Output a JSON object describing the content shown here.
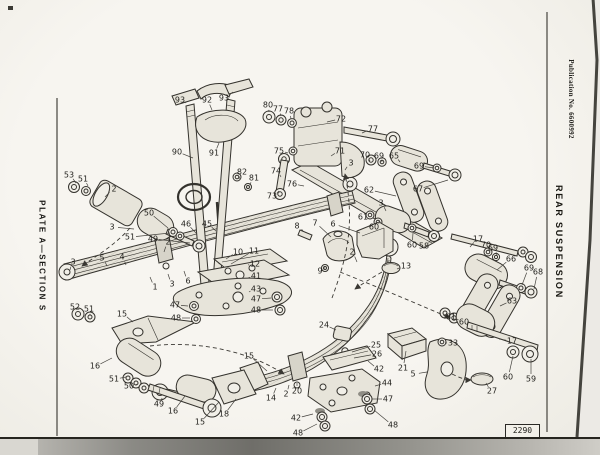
{
  "page": {
    "left_margin": {
      "plate_label": "PLATE A—SECTION S"
    },
    "right_margin": {
      "publication": "Publication No. 6600992",
      "title": "REAR SUSPENSION"
    },
    "figure_number": "2290"
  },
  "diagram": {
    "description": "Exploded parts diagram of a rear leaf-spring suspension: two leaf springs, shock absorber, U-bolts, shackles, bushes, mounting plates and fasteners, with numbered part callouts",
    "callouts": [
      {
        "n": "53",
        "x": 69,
        "y": 175,
        "lx": 76,
        "ly": 183
      },
      {
        "n": "51",
        "x": 83,
        "y": 179,
        "lx": 88,
        "ly": 186
      },
      {
        "n": "2",
        "x": 114,
        "y": 189,
        "lx": 105,
        "ly": 197
      },
      {
        "n": "50",
        "x": 149,
        "y": 213,
        "lx": 168,
        "ly": 228
      },
      {
        "n": "3",
        "x": 112,
        "y": 227,
        "lx": 134,
        "ly": 229
      },
      {
        "n": "51",
        "x": 130,
        "y": 237,
        "lx": 170,
        "ly": 233
      },
      {
        "n": "49",
        "x": 153,
        "y": 239,
        "lx": 190,
        "ly": 243
      },
      {
        "n": "3",
        "x": 73,
        "y": 262,
        "lx": 70,
        "ly": 270
      },
      {
        "n": "5",
        "x": 102,
        "y": 258,
        "lx": 107,
        "ly": 266
      },
      {
        "n": "4",
        "x": 122,
        "y": 257,
        "lx": 126,
        "ly": 265
      },
      {
        "n": "2",
        "x": 168,
        "y": 242,
        "lx": 164,
        "ly": 252
      },
      {
        "n": "1",
        "x": 155,
        "y": 287,
        "lx": 150,
        "ly": 277
      },
      {
        "n": "3",
        "x": 172,
        "y": 284,
        "lx": 168,
        "ly": 274
      },
      {
        "n": "6",
        "x": 188,
        "y": 281,
        "lx": 184,
        "ly": 271
      },
      {
        "n": "46",
        "x": 186,
        "y": 224,
        "lx": 196,
        "ly": 233
      },
      {
        "n": "45",
        "x": 207,
        "y": 224,
        "lx": 216,
        "ly": 231
      },
      {
        "n": "93",
        "x": 180,
        "y": 100,
        "lx": 186,
        "ly": 103
      },
      {
        "n": "92",
        "x": 207,
        "y": 100,
        "lx": 212,
        "ly": 110
      },
      {
        "n": "93",
        "x": 224,
        "y": 98,
        "lx": 233,
        "ly": 92
      },
      {
        "n": "90",
        "x": 177,
        "y": 152,
        "lx": 193,
        "ly": 158
      },
      {
        "n": "91",
        "x": 214,
        "y": 153,
        "lx": 219,
        "ly": 143
      },
      {
        "n": "82",
        "x": 242,
        "y": 172,
        "lx": 239,
        "ly": 179
      },
      {
        "n": "81",
        "x": 254,
        "y": 178,
        "lx": 250,
        "ly": 185
      },
      {
        "n": "80",
        "x": 268,
        "y": 105,
        "lx": 269,
        "ly": 112
      },
      {
        "n": "77",
        "x": 278,
        "y": 109,
        "lx": 281,
        "ly": 116
      },
      {
        "n": "78",
        "x": 289,
        "y": 111,
        "lx": 291,
        "ly": 119
      },
      {
        "n": "72",
        "x": 341,
        "y": 119,
        "lx": 327,
        "ly": 122
      },
      {
        "n": "77",
        "x": 373,
        "y": 129,
        "lx": 362,
        "ly": 133
      },
      {
        "n": "71",
        "x": 340,
        "y": 151,
        "lx": 331,
        "ly": 156
      },
      {
        "n": "75",
        "x": 279,
        "y": 151,
        "lx": 288,
        "ly": 153
      },
      {
        "n": "74",
        "x": 276,
        "y": 171,
        "lx": 281,
        "ly": 177
      },
      {
        "n": "73",
        "x": 272,
        "y": 196,
        "lx": 279,
        "ly": 191
      },
      {
        "n": "76",
        "x": 292,
        "y": 184,
        "lx": 304,
        "ly": 186
      },
      {
        "n": "3",
        "x": 351,
        "y": 163,
        "lx": 345,
        "ly": 170
      },
      {
        "n": "70",
        "x": 365,
        "y": 155,
        "lx": 370,
        "ly": 161
      },
      {
        "n": "69",
        "x": 379,
        "y": 156,
        "lx": 382,
        "ly": 162
      },
      {
        "n": "65",
        "x": 394,
        "y": 156,
        "lx": 400,
        "ly": 162
      },
      {
        "n": "69",
        "x": 419,
        "y": 166,
        "lx": 434,
        "ly": 168
      },
      {
        "n": "67",
        "x": 418,
        "y": 189,
        "lx": 448,
        "ly": 180
      },
      {
        "n": "62",
        "x": 369,
        "y": 190,
        "lx": 396,
        "ly": 196
      },
      {
        "n": "3",
        "x": 381,
        "y": 203,
        "lx": 386,
        "ly": 211
      },
      {
        "n": "61",
        "x": 363,
        "y": 217,
        "lx": 369,
        "ly": 216
      },
      {
        "n": "60",
        "x": 374,
        "y": 227,
        "lx": 379,
        "ly": 223
      },
      {
        "n": "60",
        "x": 412,
        "y": 245,
        "lx": 413,
        "ly": 233
      },
      {
        "n": "58",
        "x": 424,
        "y": 246,
        "lx": 431,
        "ly": 240
      },
      {
        "n": "13",
        "x": 406,
        "y": 266,
        "lx": 397,
        "ly": 269
      },
      {
        "n": "17",
        "x": 478,
        "y": 239,
        "lx": 470,
        "ly": 247
      },
      {
        "n": "70",
        "x": 486,
        "y": 245,
        "lx": 489,
        "ly": 251
      },
      {
        "n": "69",
        "x": 493,
        "y": 248,
        "lx": 497,
        "ly": 255
      },
      {
        "n": "66",
        "x": 511,
        "y": 259,
        "lx": 497,
        "ly": 270
      },
      {
        "n": "69",
        "x": 529,
        "y": 268,
        "lx": 522,
        "ly": 285
      },
      {
        "n": "68",
        "x": 538,
        "y": 272,
        "lx": 534,
        "ly": 289
      },
      {
        "n": "63",
        "x": 512,
        "y": 301,
        "lx": 500,
        "ly": 306
      },
      {
        "n": "61",
        "x": 451,
        "y": 317,
        "lx": 446,
        "ly": 314
      },
      {
        "n": "60",
        "x": 464,
        "y": 322,
        "lx": 457,
        "ly": 319
      },
      {
        "n": "17",
        "x": 512,
        "y": 341,
        "lx": 499,
        "ly": 339
      },
      {
        "n": "33",
        "x": 453,
        "y": 343,
        "lx": 445,
        "ly": 343
      },
      {
        "n": "60",
        "x": 508,
        "y": 377,
        "lx": 513,
        "ly": 356
      },
      {
        "n": "59",
        "x": 531,
        "y": 379,
        "lx": 531,
        "ly": 359
      },
      {
        "n": "27",
        "x": 492,
        "y": 391,
        "lx": 486,
        "ly": 383
      },
      {
        "n": "5",
        "x": 413,
        "y": 374,
        "lx": 427,
        "ly": 372
      },
      {
        "n": "8",
        "x": 297,
        "y": 226,
        "lx": 303,
        "ly": 231
      },
      {
        "n": "7",
        "x": 315,
        "y": 223,
        "lx": 331,
        "ly": 237
      },
      {
        "n": "6",
        "x": 333,
        "y": 224,
        "lx": 360,
        "ly": 233
      },
      {
        "n": "9",
        "x": 320,
        "y": 271,
        "lx": 324,
        "ly": 268
      },
      {
        "n": "10",
        "x": 238,
        "y": 252,
        "lx": 226,
        "ly": 259
      },
      {
        "n": "11",
        "x": 254,
        "y": 251,
        "lx": 231,
        "ly": 264
      },
      {
        "n": "12",
        "x": 255,
        "y": 264,
        "lx": 248,
        "ly": 265
      },
      {
        "n": "41",
        "x": 256,
        "y": 276,
        "lx": 248,
        "ly": 278
      },
      {
        "n": "43",
        "x": 256,
        "y": 289,
        "lx": 249,
        "ly": 292
      },
      {
        "n": "47",
        "x": 256,
        "y": 299,
        "lx": 271,
        "ly": 298
      },
      {
        "n": "48",
        "x": 256,
        "y": 310,
        "lx": 273,
        "ly": 310
      },
      {
        "n": "47",
        "x": 175,
        "y": 305,
        "lx": 188,
        "ly": 306
      },
      {
        "n": "48",
        "x": 176,
        "y": 318,
        "lx": 190,
        "ly": 318
      },
      {
        "n": "15",
        "x": 122,
        "y": 314,
        "lx": 133,
        "ly": 322
      },
      {
        "n": "52",
        "x": 75,
        "y": 307,
        "lx": 78,
        "ly": 312
      },
      {
        "n": "51",
        "x": 89,
        "y": 309,
        "lx": 90,
        "ly": 315
      },
      {
        "n": "16",
        "x": 95,
        "y": 366,
        "lx": 112,
        "ly": 358
      },
      {
        "n": "51",
        "x": 114,
        "y": 379,
        "lx": 126,
        "ly": 377
      },
      {
        "n": "50",
        "x": 129,
        "y": 386,
        "lx": 138,
        "ly": 384
      },
      {
        "n": "49",
        "x": 159,
        "y": 404,
        "lx": 162,
        "ly": 398
      },
      {
        "n": "16",
        "x": 173,
        "y": 411,
        "lx": 185,
        "ly": 396
      },
      {
        "n": "15",
        "x": 200,
        "y": 422,
        "lx": 219,
        "ly": 402
      },
      {
        "n": "18",
        "x": 224,
        "y": 414,
        "lx": 236,
        "ly": 399
      },
      {
        "n": "14",
        "x": 271,
        "y": 398,
        "lx": 276,
        "ly": 388
      },
      {
        "n": "2",
        "x": 286,
        "y": 394,
        "lx": 289,
        "ly": 385
      },
      {
        "n": "20",
        "x": 297,
        "y": 391,
        "lx": 297,
        "ly": 383
      },
      {
        "n": "15",
        "x": 249,
        "y": 356,
        "lx": 267,
        "ly": 371
      },
      {
        "n": "2",
        "x": 352,
        "y": 252,
        "lx": 357,
        "ly": 262
      },
      {
        "n": "24",
        "x": 324,
        "y": 325,
        "lx": 336,
        "ly": 330
      },
      {
        "n": "25",
        "x": 376,
        "y": 345,
        "lx": 352,
        "ly": 352
      },
      {
        "n": "26",
        "x": 377,
        "y": 354,
        "lx": 354,
        "ly": 358
      },
      {
        "n": "42",
        "x": 379,
        "y": 369,
        "lx": 368,
        "ly": 361
      },
      {
        "n": "21",
        "x": 403,
        "y": 368,
        "lx": 406,
        "ly": 351
      },
      {
        "n": "44",
        "x": 387,
        "y": 383,
        "lx": 375,
        "ly": 386
      },
      {
        "n": "47",
        "x": 388,
        "y": 399,
        "lx": 372,
        "ly": 399
      },
      {
        "n": "48",
        "x": 393,
        "y": 425,
        "lx": 374,
        "ly": 410
      },
      {
        "n": "42",
        "x": 296,
        "y": 418,
        "lx": 313,
        "ly": 414
      },
      {
        "n": "48",
        "x": 298,
        "y": 433,
        "lx": 317,
        "ly": 424
      }
    ]
  }
}
